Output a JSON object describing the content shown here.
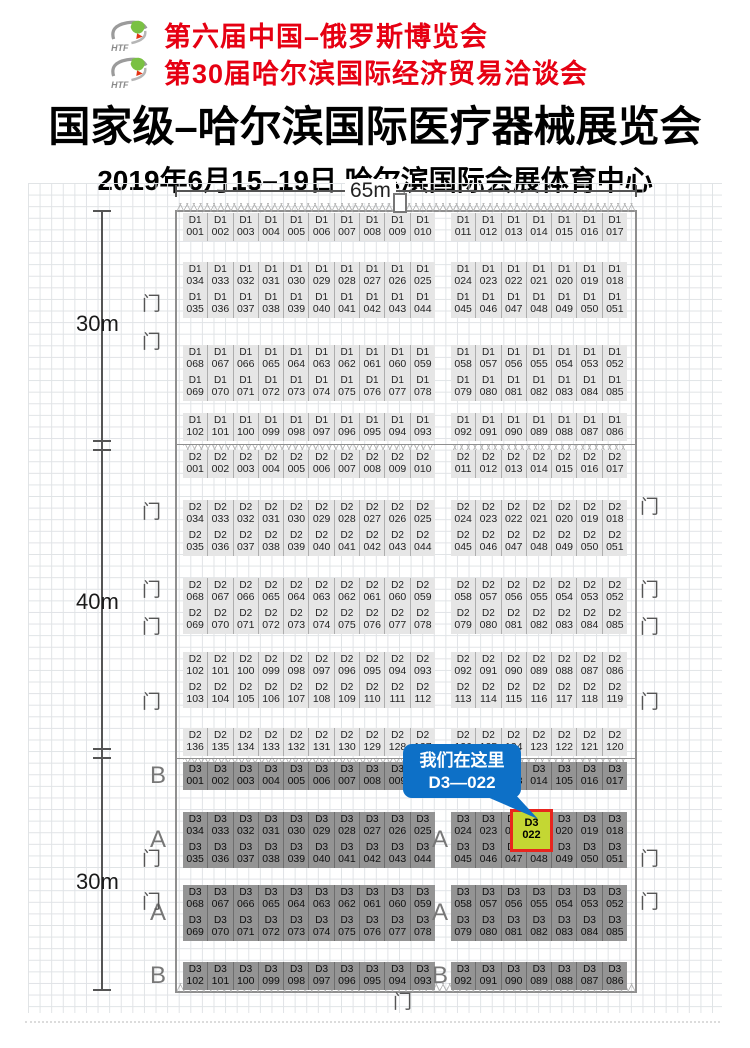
{
  "header": {
    "logo_text": "HTF",
    "event_line1": "第六届中国–俄罗斯博览会",
    "event_line2": "第30届哈尔滨国际经济贸易洽谈会",
    "title": "国家级–哈尔滨国际医疗器械展览会",
    "subtitle": "2019年6月15–19日  哈尔滨国际会展体育中心"
  },
  "dimensions": {
    "top": "65m",
    "left_sections": [
      "30m",
      "40m",
      "30m"
    ]
  },
  "door_label": "门",
  "callout": {
    "line1": "我们在这里",
    "line2": "D3—022",
    "color": "#0d70c7"
  },
  "highlight": {
    "hall": "D3",
    "number": "022",
    "fill": "#c4d733",
    "border": "#e8251e"
  },
  "colors": {
    "event_text": "#e60012",
    "light_booth": "#e6e6e6",
    "dark_booth": "#949494"
  },
  "plan": {
    "bands": [
      {
        "hall": "D1",
        "y": 30,
        "dark": false,
        "rows": [
          {
            "left": [
              "001",
              "002",
              "003",
              "004",
              "005",
              "006",
              "007",
              "008",
              "009",
              "010"
            ],
            "right": [
              "011",
              "012",
              "013",
              "014",
              "015",
              "016",
              "017"
            ]
          }
        ]
      },
      {
        "hall": "D1",
        "y": 79,
        "dark": false,
        "rows": [
          {
            "left": [
              "034",
              "033",
              "032",
              "031",
              "030",
              "029",
              "028",
              "027",
              "026",
              "025"
            ],
            "right": [
              "024",
              "023",
              "022",
              "021",
              "020",
              "019",
              "018"
            ]
          },
          {
            "left": [
              "035",
              "036",
              "037",
              "038",
              "039",
              "040",
              "041",
              "042",
              "043",
              "044"
            ],
            "right": [
              "045",
              "046",
              "047",
              "048",
              "049",
              "050",
              "051"
            ]
          }
        ]
      },
      {
        "hall": "D1",
        "y": 162,
        "dark": false,
        "rows": [
          {
            "left": [
              "068",
              "067",
              "066",
              "065",
              "064",
              "063",
              "062",
              "061",
              "060",
              "059"
            ],
            "right": [
              "058",
              "057",
              "056",
              "055",
              "054",
              "053",
              "052"
            ]
          },
          {
            "left": [
              "069",
              "070",
              "071",
              "072",
              "073",
              "074",
              "075",
              "076",
              "077",
              "078"
            ],
            "right": [
              "079",
              "080",
              "081",
              "082",
              "083",
              "084",
              "085"
            ]
          }
        ]
      },
      {
        "hall": "D1",
        "y": 230,
        "dark": false,
        "rows": [
          {
            "left": [
              "102",
              "101",
              "100",
              "099",
              "098",
              "097",
              "096",
              "095",
              "094",
              "093"
            ],
            "right": [
              "092",
              "091",
              "090",
              "089",
              "088",
              "087",
              "086"
            ]
          }
        ]
      },
      {
        "hall": "D2",
        "y": 267,
        "dark": false,
        "rows": [
          {
            "left": [
              "001",
              "002",
              "003",
              "004",
              "005",
              "006",
              "007",
              "008",
              "009",
              "010"
            ],
            "right": [
              "011",
              "012",
              "013",
              "014",
              "015",
              "016",
              "017"
            ]
          }
        ]
      },
      {
        "hall": "D2",
        "y": 317,
        "dark": false,
        "rows": [
          {
            "left": [
              "034",
              "033",
              "032",
              "031",
              "030",
              "029",
              "028",
              "027",
              "026",
              "025"
            ],
            "right": [
              "024",
              "023",
              "022",
              "021",
              "020",
              "019",
              "018"
            ]
          },
          {
            "left": [
              "035",
              "036",
              "037",
              "038",
              "039",
              "040",
              "041",
              "042",
              "043",
              "044"
            ],
            "right": [
              "045",
              "046",
              "047",
              "048",
              "049",
              "050",
              "051"
            ]
          }
        ]
      },
      {
        "hall": "D2",
        "y": 395,
        "dark": false,
        "rows": [
          {
            "left": [
              "068",
              "067",
              "066",
              "065",
              "064",
              "063",
              "062",
              "061",
              "060",
              "059"
            ],
            "right": [
              "058",
              "057",
              "056",
              "055",
              "054",
              "053",
              "052"
            ]
          },
          {
            "left": [
              "069",
              "070",
              "071",
              "072",
              "073",
              "074",
              "075",
              "076",
              "077",
              "078"
            ],
            "right": [
              "079",
              "080",
              "081",
              "082",
              "083",
              "084",
              "085"
            ]
          }
        ]
      },
      {
        "hall": "D2",
        "y": 469,
        "dark": false,
        "rows": [
          {
            "left": [
              "102",
              "101",
              "100",
              "099",
              "098",
              "097",
              "096",
              "095",
              "094",
              "093"
            ],
            "right": [
              "092",
              "091",
              "090",
              "089",
              "088",
              "087",
              "086"
            ]
          },
          {
            "left": [
              "103",
              "104",
              "105",
              "106",
              "107",
              "108",
              "109",
              "110",
              "111",
              "112"
            ],
            "right": [
              "113",
              "114",
              "115",
              "116",
              "117",
              "118",
              "119"
            ]
          }
        ]
      },
      {
        "hall": "D2",
        "y": 545,
        "dark": false,
        "rows": [
          {
            "left": [
              "136",
              "135",
              "134",
              "133",
              "132",
              "131",
              "130",
              "129",
              "128",
              "127"
            ],
            "right": [
              "126",
              "125",
              "124",
              "123",
              "122",
              "121",
              "120"
            ]
          }
        ]
      },
      {
        "hall": "D3",
        "y": 579,
        "dark": true,
        "label_left": "B",
        "rows": [
          {
            "left": [
              "001",
              "002",
              "003",
              "004",
              "005",
              "006",
              "007",
              "008",
              "009",
              "010"
            ],
            "right": [
              "011",
              "012",
              "013",
              "014",
              "105",
              "016",
              "017"
            ]
          }
        ]
      },
      {
        "hall": "D3",
        "y": 629,
        "dark": true,
        "label_left": "A",
        "label_mid": "A",
        "rows": [
          {
            "left": [
              "034",
              "033",
              "032",
              "031",
              "030",
              "029",
              "028",
              "027",
              "026",
              "025"
            ],
            "right": [
              "024",
              "023",
              "022",
              "021",
              "020",
              "019",
              "018"
            ]
          },
          {
            "left": [
              "035",
              "036",
              "037",
              "038",
              "039",
              "040",
              "041",
              "042",
              "043",
              "044"
            ],
            "right": [
              "045",
              "046",
              "047",
              "048",
              "049",
              "050",
              "051"
            ]
          }
        ]
      },
      {
        "hall": "D3",
        "y": 702,
        "dark": true,
        "label_left": "A",
        "label_mid": "A",
        "rows": [
          {
            "left": [
              "068",
              "067",
              "066",
              "065",
              "064",
              "063",
              "062",
              "061",
              "060",
              "059"
            ],
            "right": [
              "058",
              "057",
              "056",
              "055",
              "054",
              "053",
              "052"
            ]
          },
          {
            "left": [
              "069",
              "070",
              "071",
              "072",
              "073",
              "074",
              "075",
              "076",
              "077",
              "078"
            ],
            "right": [
              "079",
              "080",
              "081",
              "082",
              "083",
              "084",
              "085"
            ]
          }
        ]
      },
      {
        "hall": "D3",
        "y": 779,
        "dark": true,
        "label_left": "B",
        "label_mid": "B",
        "rows": [
          {
            "left": [
              "102",
              "101",
              "100",
              "099",
              "098",
              "097",
              "096",
              "095",
              "094",
              "093"
            ],
            "right": [
              "092",
              "091",
              "090",
              "089",
              "088",
              "087",
              "086"
            ]
          }
        ]
      }
    ]
  }
}
